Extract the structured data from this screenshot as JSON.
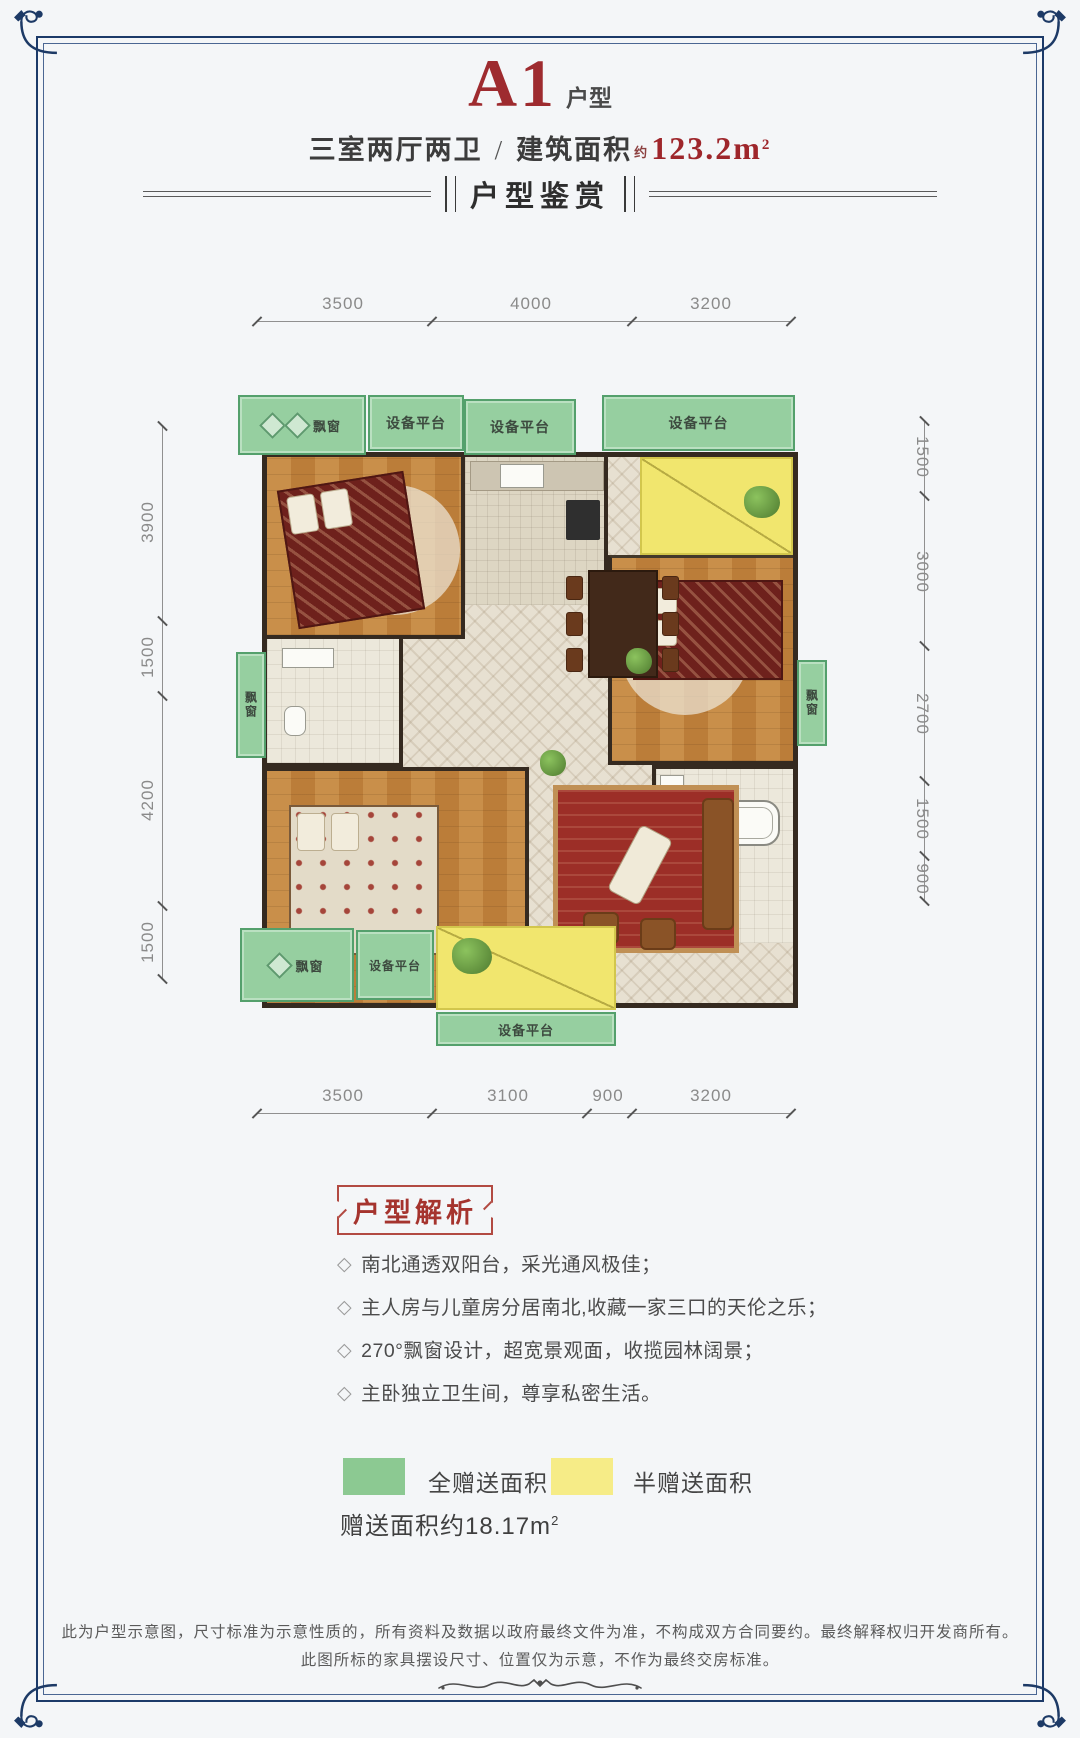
{
  "header": {
    "unit_code": "A1",
    "unit_suffix": "户型",
    "spec": "三室两厅两卫",
    "slash": "/",
    "area_label": "建筑面积",
    "area_approx": "约",
    "area_value": "123.2m",
    "area_sup": "2"
  },
  "banner": {
    "title": "户型鉴赏"
  },
  "plan": {
    "dims": {
      "top": [
        "3500",
        "4000",
        "3200"
      ],
      "bottom": [
        "3500",
        "3100",
        "900",
        "3200"
      ],
      "left": [
        "3900",
        "1500",
        "4200",
        "1500"
      ],
      "right": [
        "1500",
        "3000",
        "2700",
        "1500",
        "900"
      ]
    },
    "labels": {
      "bay_window": "飘窗",
      "equipment_platform": "设备平台"
    }
  },
  "analysis": {
    "title": "户型解析",
    "marker": "◇",
    "bullets": [
      "南北通透双阳台，采光通风极佳；",
      "主人房与儿童房分居南北,收藏一家三口的天伦之乐；",
      "270°飘窗设计，超宽景观面，收揽园林阔景；",
      "主卧独立卫生间，尊享私密生活。"
    ]
  },
  "legend": {
    "full": "全赠送面积",
    "half": "半赠送面积",
    "full_color": "#8cc992",
    "half_color": "#f6ec87",
    "note": "赠送面积约18.17m",
    "note_sup": "2"
  },
  "footer": {
    "line1": "此为户型示意图，尺寸标准为示意性质的，所有资料及数据以政府最终文件为准，不构成双方合同要约。最终解释权归开发商所有。",
    "line2": "此图所标的家具摆设尺寸、位置仅为示意，不作为最终交房标准。"
  }
}
